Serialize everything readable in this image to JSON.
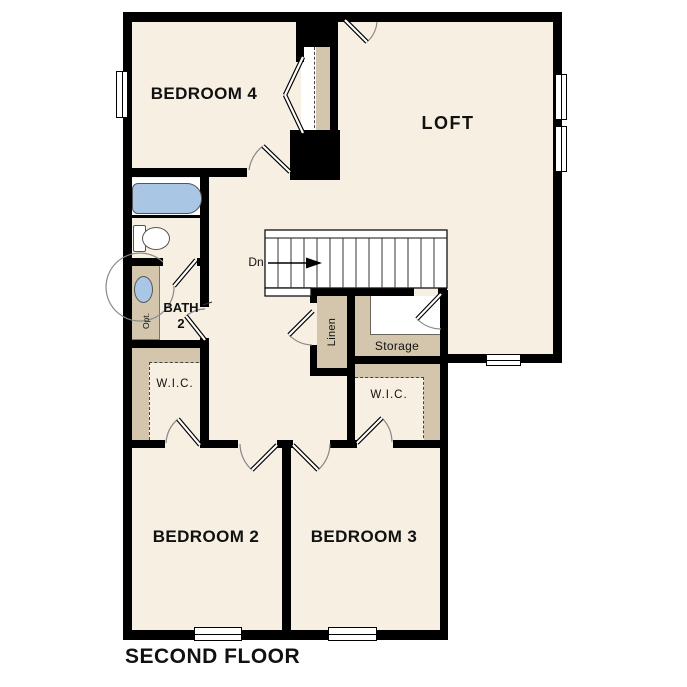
{
  "title": "SECOND FLOOR",
  "rooms": {
    "bedroom4": "BEDROOM 4",
    "loft": "LOFT",
    "bath_label": "BATH\n2",
    "linen": "Linen",
    "storage": "Storage",
    "wic_left": "W.I.C.",
    "wic_right": "W.I.C.",
    "bedroom2": "BEDROOM 2",
    "bedroom3": "BEDROOM 3"
  },
  "stairs": {
    "direction_label": "Dn"
  },
  "fixtures": {
    "vanity_note": "Opt."
  },
  "colors": {
    "wall": "#000000",
    "floor": "#f6efe2",
    "casework": "#d3c6ac",
    "fixture_blue": "#a9c7e5",
    "background": "#ffffff"
  }
}
